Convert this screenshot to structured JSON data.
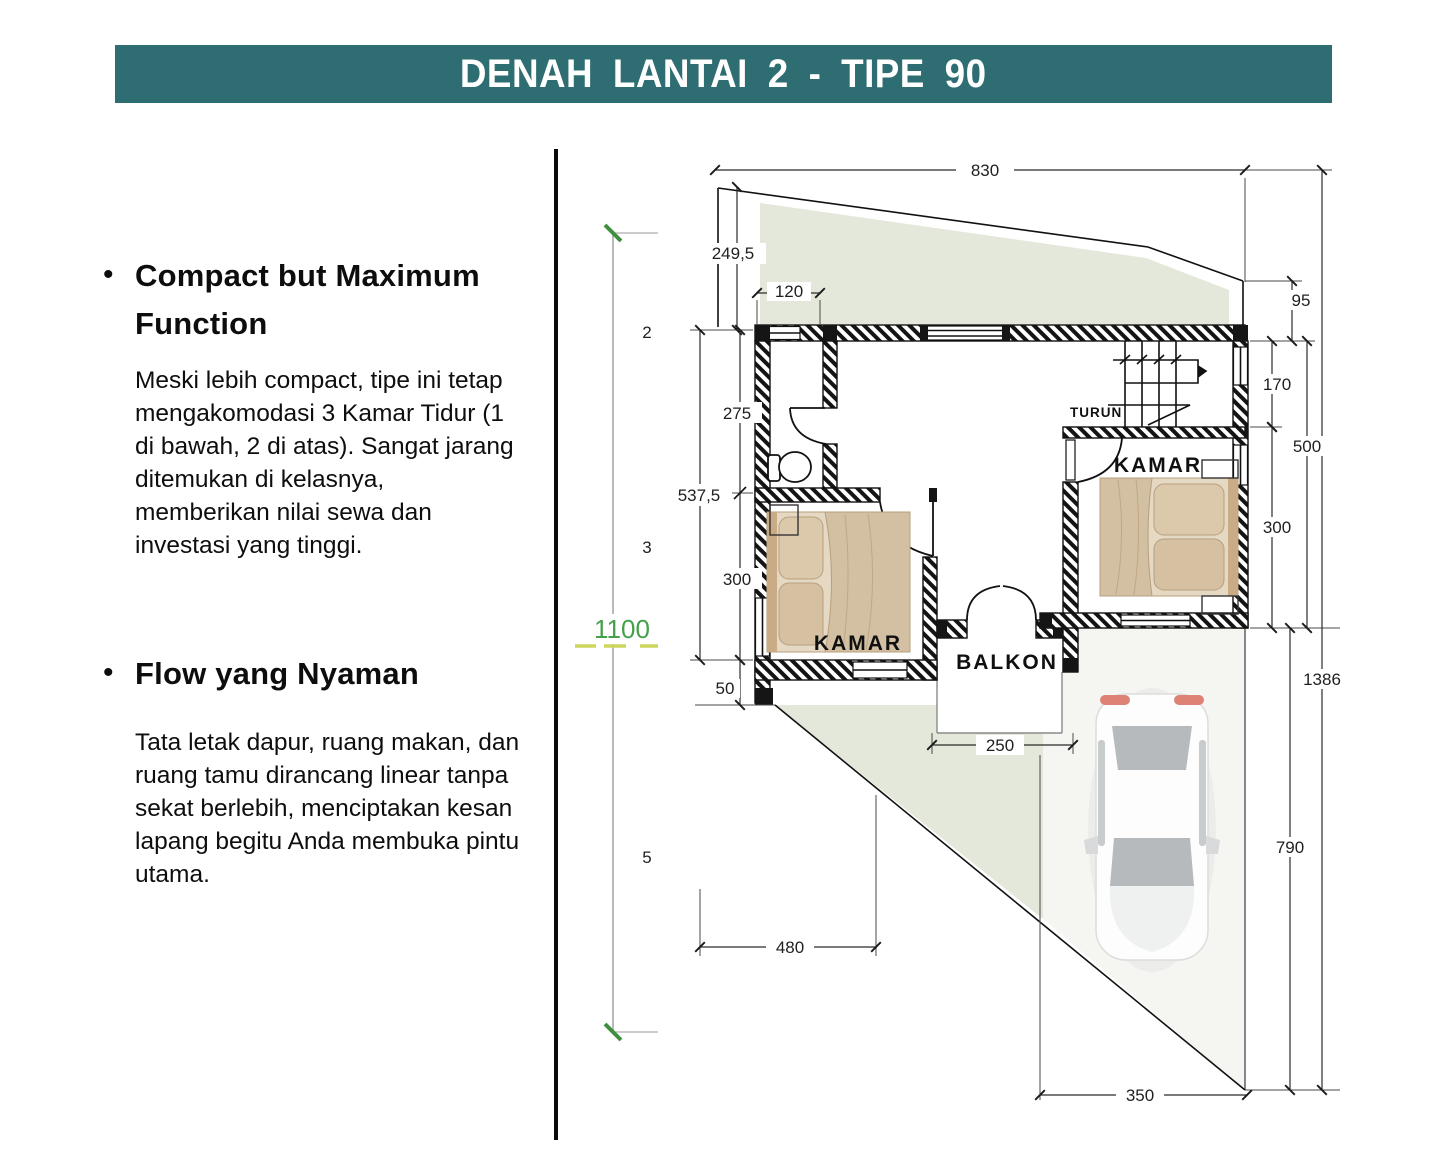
{
  "header": {
    "title": "DENAH LANTAI 2 - TIPE 90",
    "bar_color": "#2e6d71"
  },
  "sections": [
    {
      "bullet": "•",
      "heading": "Compact but Maximum Function",
      "body": "Meski lebih compact, tipe ini tetap mengakomodasi 3 Kamar Tidur (1 di bawah, 2 di atas). Sangat jarang ditemukan di kelasnya, memberikan nilai sewa dan investasi yang tinggi."
    },
    {
      "bullet": "•",
      "heading": "Flow yang Nyaman",
      "body": "Tata letak dapur, ruang makan, dan ruang tamu dirancang linear tanpa sekat berlebih, menciptakan kesan lapang begitu Anda membuka pintu utama."
    }
  ],
  "plan": {
    "labels": {
      "kamar_left": "KAMAR",
      "kamar_right": "KAMAR",
      "balkon": "BALKON",
      "turun": "TURUN"
    },
    "dims": {
      "d830": "830",
      "d2495": "249,5",
      "d120": "120",
      "d275": "275",
      "d5375": "537,5",
      "d300l": "300",
      "d50": "50",
      "d1100": "1100",
      "d95": "95",
      "d170": "170",
      "d500": "500",
      "d300r": "300",
      "d1386": "1386",
      "d790": "790",
      "d480": "480",
      "d250": "250",
      "d350": "350",
      "p2": "2",
      "p3": "3",
      "p5": "5"
    },
    "colors": {
      "roof_green": "#e3e8da",
      "site_dim_green": "#44a04a",
      "dash_yellow": "#cdd75c",
      "wall_black": "#151515",
      "bed_tan": "#d3bfa2"
    }
  }
}
